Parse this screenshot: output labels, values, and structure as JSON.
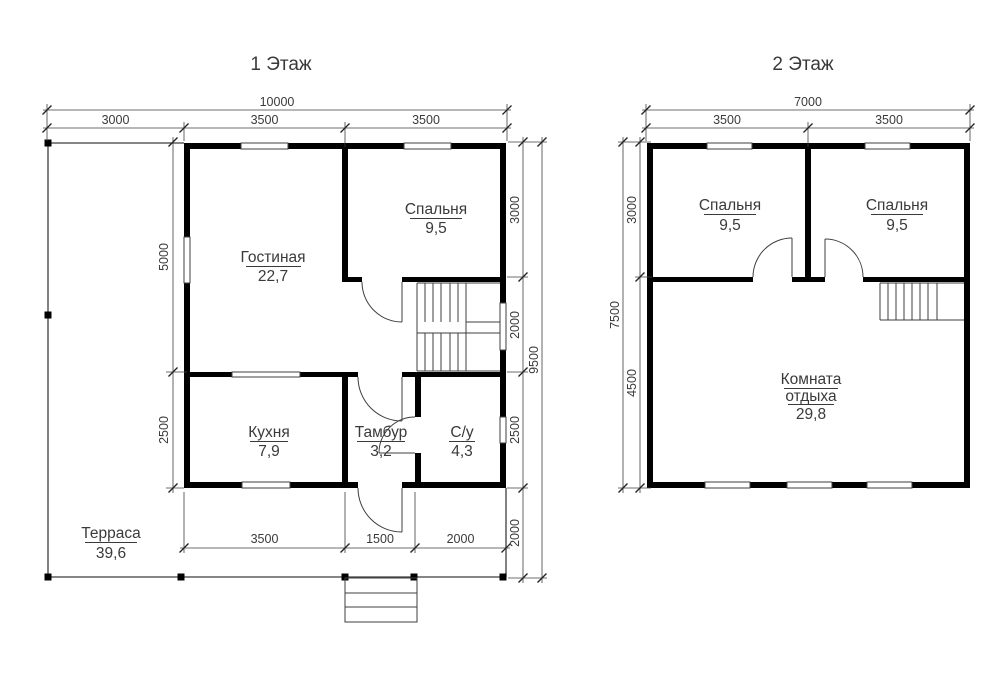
{
  "floor1": {
    "title": "1 Этаж",
    "dim_total": "10000",
    "dim_top": [
      "3000",
      "3500",
      "3500"
    ],
    "dim_bottom": [
      "3500",
      "1500",
      "2000"
    ],
    "dim_left": [
      "5000",
      "2500"
    ],
    "dim_right": [
      "3000",
      "2000",
      "2500",
      "2000"
    ],
    "dim_right_total": "9500",
    "rooms": {
      "living": {
        "name": "Гостиная",
        "area": "22,7"
      },
      "bedroom": {
        "name": "Спальня",
        "area": "9,5"
      },
      "kitchen": {
        "name": "Кухня",
        "area": "7,9"
      },
      "vestibule": {
        "name": "Тамбур",
        "area": "3,2"
      },
      "bathroom": {
        "name": "С/у",
        "area": "4,3"
      },
      "terrace": {
        "name": "Терраса",
        "area": "39,6"
      }
    }
  },
  "floor2": {
    "title": "2 Этаж",
    "dim_total": "7000",
    "dim_top": [
      "3500",
      "3500"
    ],
    "dim_left": [
      "3000",
      "4500"
    ],
    "dim_left_total": "7500",
    "rooms": {
      "bedroom_left": {
        "name": "Спальня",
        "area": "9,5"
      },
      "bedroom_right": {
        "name": "Спальня",
        "area": "9,5"
      },
      "lounge": {
        "line1": "Комната",
        "line2": "отдыха",
        "area": "29,8"
      }
    }
  },
  "colors": {
    "walls": "#000000",
    "lines": "#3f3f3f",
    "text": "#3a3a3a",
    "background": "#ffffff"
  }
}
